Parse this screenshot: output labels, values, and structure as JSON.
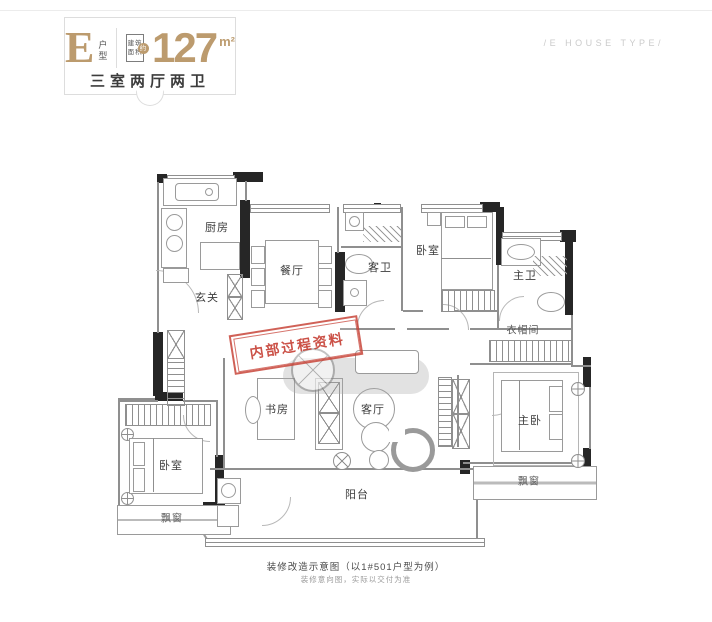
{
  "header": {
    "type_letter": "E",
    "type_suffix_char1": "户",
    "type_suffix_char2": "型",
    "area_box_line1": "建筑",
    "area_box_line2": "面积",
    "area_approx": "约",
    "area_value": "127",
    "area_unit": "m²",
    "layout_text": "三室两厅两卫"
  },
  "en_caption": "/E HOUSE TYPE/",
  "stamp": {
    "text": "内部过程资料"
  },
  "rooms": [
    {
      "id": "kitchen",
      "label": "厨房"
    },
    {
      "id": "dining",
      "label": "餐厅"
    },
    {
      "id": "entry",
      "label": "玄关"
    },
    {
      "id": "guest-bath",
      "label": "客卫"
    },
    {
      "id": "bedroom-2",
      "label": "卧室"
    },
    {
      "id": "master-bath",
      "label": "主卫"
    },
    {
      "id": "cloakroom",
      "label": "衣帽间"
    },
    {
      "id": "study",
      "label": "书房"
    },
    {
      "id": "living",
      "label": "客厅"
    },
    {
      "id": "master-bedroom",
      "label": "主卧"
    },
    {
      "id": "bedroom-3",
      "label": "卧室"
    },
    {
      "id": "bay-window-left",
      "label": "飘窗"
    },
    {
      "id": "bay-window-right",
      "label": "飘窗"
    },
    {
      "id": "balcony",
      "label": "阳台"
    }
  ],
  "footer": {
    "line1": "装修改造示意图（以1#501户型为例）",
    "line2": "装修意向图，实际以交付为准"
  },
  "colors": {
    "accent_gold": "#bc9b6e",
    "stamp_red": "#c4392d",
    "wall_black": "#262626",
    "line_gray": "#8f8f8f"
  }
}
